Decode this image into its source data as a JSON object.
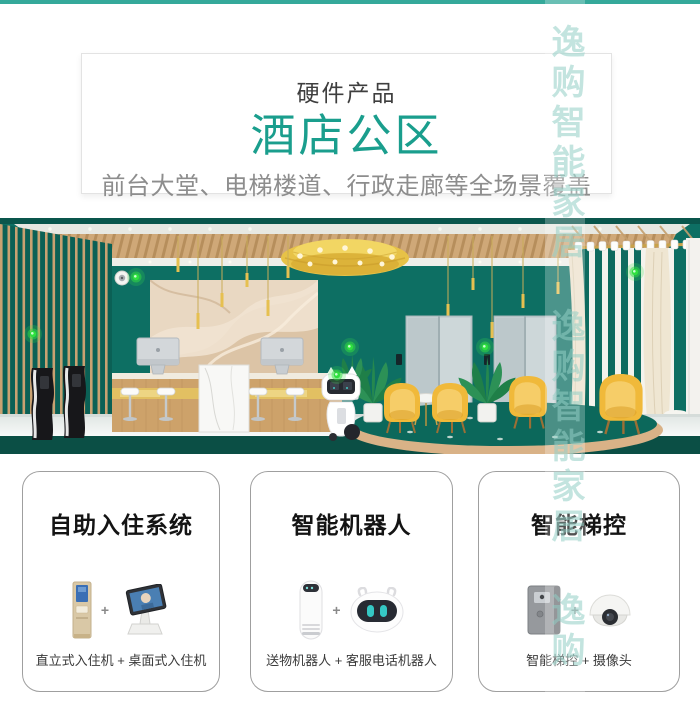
{
  "page": {
    "top_bar_color": "#35a99a",
    "watermark_text": "逸购智能家居",
    "watermark_color": "#8fc9c0"
  },
  "header": {
    "eyebrow": "硬件产品",
    "title": "酒店公区",
    "title_color": "#1a9e8d",
    "subtitle": "前台大堂、电梯楼道、行政走廊等全场景覆盖"
  },
  "lobby": {
    "type": "illustration",
    "wall_color": "#0d6f63",
    "accent_gold": "#e7c247",
    "status_green": "#2ee03e"
  },
  "cards": [
    {
      "title": "自助入住系统",
      "plus": "+",
      "caption": "直立式入住机 + 桌面式入住机",
      "device_icons": [
        "standing-checkin-kiosk-icon",
        "desktop-checkin-machine-icon"
      ]
    },
    {
      "title": "智能机器人",
      "plus": "+",
      "caption": "送物机器人 + 客服电话机器人",
      "device_icons": [
        "delivery-robot-icon",
        "service-robot-head-icon"
      ]
    },
    {
      "title": "智能梯控",
      "plus": "+",
      "caption": "智能梯控 + 摄像头",
      "device_icons": [
        "elevator-control-panel-icon",
        "dome-camera-icon"
      ]
    }
  ]
}
